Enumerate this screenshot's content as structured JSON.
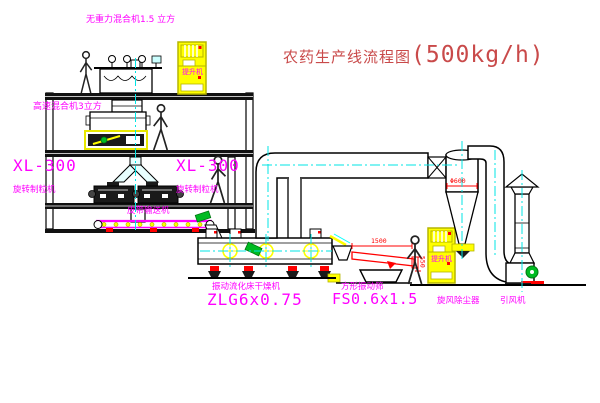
{
  "title": {
    "text": "农药生产线流程图",
    "capacity": "(500kg/h)"
  },
  "equipment_labels": {
    "gravity_mixer": "无重力混合机1.5 立方",
    "high_speed_mixer": "高速混合机3立方",
    "granulator_left_model": "XL-300",
    "granulator_left_name": "旋转制粒机",
    "granulator_mid_model": "XL-300",
    "granulator_mid_name": "旋转制粒机",
    "belt_conveyor": "皮带输送机",
    "fluid_bed_dryer_name": "振动流化床干燥机",
    "fluid_bed_dryer_model": "ZLG6x0.75",
    "square_sieve_name": "方形振动筛",
    "square_sieve_model": "FS0.6x1.5",
    "cyclone": "旋风除尘器",
    "induced_draft_fan": "引风机",
    "elevator_1": "提升机",
    "elevator_2": "提升机"
  },
  "dimensions": {
    "cyclone_diameter": "Φ600",
    "sieve_length": "1500",
    "sieve_height": "550"
  },
  "colors": {
    "label_magenta": "#FF00FF",
    "title_red": "#C94A4A",
    "dimension_red": "#FF0000",
    "equipment_yellow": "#FFFF00",
    "centerline_cyan": "#00E5E5",
    "motor_green": "#00BB22",
    "line_black": "#000000"
  }
}
